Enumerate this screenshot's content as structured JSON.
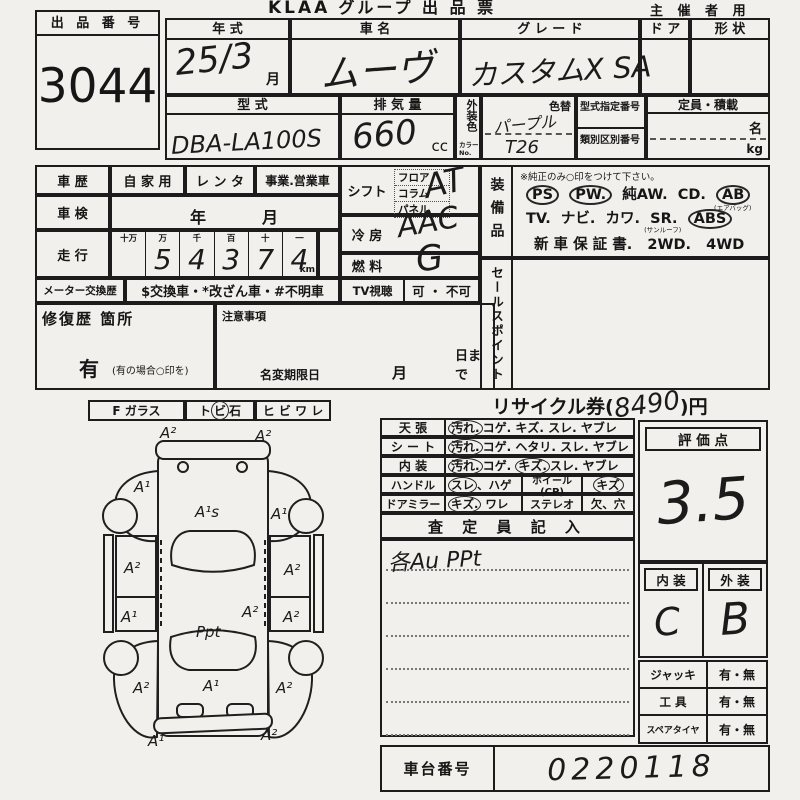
{
  "header": {
    "logo": "KLAA",
    "title": "グループ 出 品 票",
    "right": "主 催 者 用"
  },
  "lot": {
    "label": "出 品 番 号",
    "number": "3044"
  },
  "top": {
    "year": {
      "label": "年      式",
      "value": "25/3",
      "unit": "月"
    },
    "name": {
      "label": "車      名",
      "value": "ムーヴ"
    },
    "grade": {
      "label": "グ  レ  ー  ド",
      "value": "カスタムX SA"
    },
    "door": {
      "label": "ド ア"
    },
    "shape": {
      "label": "形  状"
    },
    "model": {
      "label": "型      式",
      "value": "DBA-LA100S"
    },
    "disp": {
      "label": "排  気  量",
      "value": "660",
      "unit": "cc"
    },
    "color": {
      "side": "外装色",
      "side_sub": "カラーNo.",
      "change": "色替",
      "value": "パープル",
      "code": "T26"
    },
    "desig": {
      "label": "型式指定番号"
    },
    "classification": {
      "label": "類別区別番号"
    },
    "capacity": {
      "label": "定員・積載",
      "persons": "名",
      "weight": "kg"
    }
  },
  "left": {
    "history": {
      "label": "車  歴",
      "opt1": "自 家 用",
      "opt2": "レ ン タ",
      "opt3": "事業.営業車"
    },
    "inspection": {
      "label": "車  検",
      "year": "年",
      "month": "月"
    },
    "mileage": {
      "label": "走  行",
      "h": [
        "十万",
        "万",
        "千",
        "百",
        "十",
        "一"
      ],
      "d": [
        "",
        "5",
        "4",
        "3",
        "7",
        "4"
      ],
      "unit": "km"
    },
    "meter": {
      "label": "メーター交換歴",
      "value": "$交換車・*改ざん車・#不明車"
    },
    "repair": {
      "label": "修復歴  箇所",
      "yes": "有",
      "note": "(有の場合○印を)"
    },
    "caution": {
      "label": "注意事項",
      "name_change": "名変期限日",
      "month": "月",
      "day": "日まで"
    }
  },
  "mid": {
    "shift": {
      "label": "シフト",
      "o1": "フロア",
      "o2": "コラム",
      "o3": "パネル",
      "value": "AT"
    },
    "ac": {
      "label": "冷  房",
      "value": "AAC"
    },
    "fuel": {
      "label": "燃  料",
      "value": "G"
    },
    "tv": {
      "label": "TV視聴",
      "value": "可 ・ 不可"
    }
  },
  "equip": {
    "label": "装備品",
    "note": "※純正のみ○印をつけて下さい。",
    "r1": [
      {
        "t": "PS",
        "c": true
      },
      {
        "t": "PW.",
        "c": true
      },
      {
        "t": "純AW.",
        "c": false
      },
      {
        "t": "CD.",
        "c": false
      },
      {
        "t": "AB",
        "c": true
      }
    ],
    "r1sub": "(エアバッグ)",
    "r2": [
      {
        "t": "TV.",
        "c": false
      },
      {
        "t": "ナビ.",
        "c": false
      },
      {
        "t": "カワ.",
        "c": false
      },
      {
        "t": "SR.",
        "c": false
      },
      {
        "t": "ABS",
        "c": true
      }
    ],
    "r2sub": "(サンルーフ)",
    "r3": [
      {
        "t": "新 車 保 証 書.",
        "c": false
      },
      {
        "t": "2WD.",
        "c": false
      },
      {
        "t": "4WD",
        "c": false
      }
    ]
  },
  "sales": {
    "label": "セールスポイント"
  },
  "recycle": {
    "label": "リサイクル券(",
    "value": "8490",
    "suffix": ")円"
  },
  "glass": {
    "f": "F ガラス",
    "t1": "ト",
    "t2": "ビ",
    "t3": "石",
    "h": "ヒ ビ ワ レ"
  },
  "cond": {
    "r1": {
      "label": "天    張",
      "o": [
        {
          "t": "汚れ.",
          "c": true
        },
        {
          "t": "コゲ.",
          "c": false
        },
        {
          "t": "キズ.",
          "c": false
        },
        {
          "t": "スレ.",
          "c": false
        },
        {
          "t": "ヤブレ",
          "c": false
        }
      ]
    },
    "r2": {
      "label": "シ ー ト",
      "o": [
        {
          "t": "汚れ.",
          "c": true
        },
        {
          "t": "コゲ.",
          "c": false
        },
        {
          "t": "ヘタリ.",
          "c": false
        },
        {
          "t": "スレ.",
          "c": false
        },
        {
          "t": "ヤブレ",
          "c": false
        }
      ]
    },
    "r3": {
      "label": "内    装",
      "o": [
        {
          "t": "汚れ.",
          "c": true
        },
        {
          "t": "コゲ.",
          "c": false
        },
        {
          "t": "キズ.",
          "c": true
        },
        {
          "t": "スレ.",
          "c": false
        },
        {
          "t": "ヤブレ",
          "c": false
        }
      ]
    },
    "handle": {
      "label": "ハンドル",
      "o1": "スレ",
      "o2": "、ハゲ"
    },
    "wheel": {
      "label": "ホイール(CP)",
      "value": "キズ"
    },
    "mirror": {
      "label": "ドアミラー",
      "o1": "キズ.",
      "o2": "ワレ"
    },
    "stereo": {
      "label": "ステレオ",
      "value": "欠、穴"
    }
  },
  "insp": {
    "label": "査 定 員 記 入",
    "note": "各Au PPt"
  },
  "score": {
    "label": "評  価  点",
    "value": "3.5"
  },
  "interior": {
    "label": "内  装",
    "value": "C"
  },
  "exterior": {
    "label": "外  装",
    "value": "B"
  },
  "acc": {
    "r1": {
      "label": "ジャッキ",
      "value": "有・無"
    },
    "r2": {
      "label": "工    具",
      "value": "有・無"
    },
    "r3": {
      "label": "スペアタイヤ",
      "value": "有・無"
    }
  },
  "chassis": {
    "label": "車台番号",
    "value": "0220118"
  },
  "diagram": {
    "annotations": [
      {
        "t": "A²",
        "x": 160,
        "y": 438
      },
      {
        "t": "A²",
        "x": 255,
        "y": 441
      },
      {
        "t": "A¹",
        "x": 134,
        "y": 492
      },
      {
        "t": "A¹s",
        "x": 195,
        "y": 517
      },
      {
        "t": "A¹",
        "x": 271,
        "y": 519
      },
      {
        "t": "A²",
        "x": 124,
        "y": 573
      },
      {
        "t": "A²",
        "x": 284,
        "y": 575
      },
      {
        "t": "A¹",
        "x": 121,
        "y": 622
      },
      {
        "t": "A²",
        "x": 242,
        "y": 617
      },
      {
        "t": "A²",
        "x": 283,
        "y": 622
      },
      {
        "t": "Ppt",
        "x": 196,
        "y": 637
      },
      {
        "t": "A²",
        "x": 133,
        "y": 693
      },
      {
        "t": "A¹",
        "x": 203,
        "y": 691
      },
      {
        "t": "A²",
        "x": 276,
        "y": 693
      },
      {
        "t": "A¹",
        "x": 148,
        "y": 746
      },
      {
        "t": "A²",
        "x": 261,
        "y": 740
      }
    ]
  }
}
